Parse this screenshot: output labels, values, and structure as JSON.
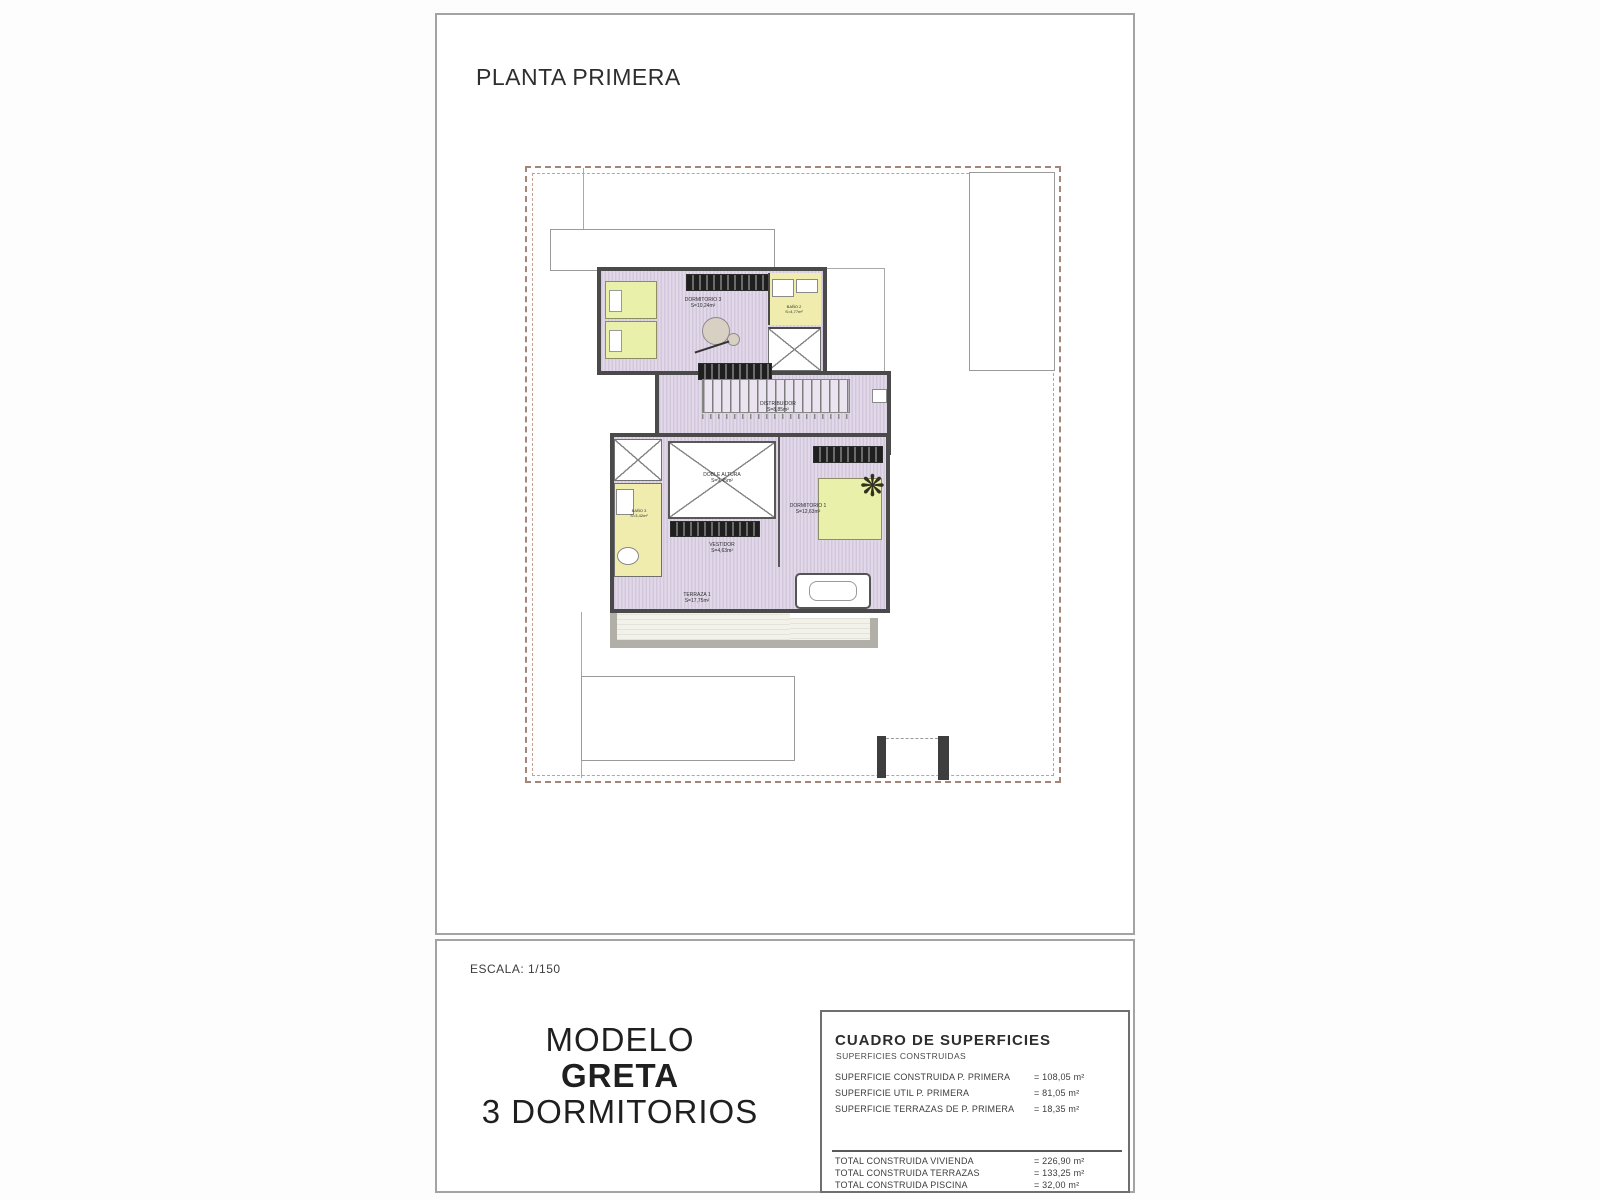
{
  "header": {
    "title": "PLANTA PRIMERA"
  },
  "footer": {
    "scale": "ESCALA: 1/150",
    "model": {
      "line1": "MODELO",
      "line2": "GRETA",
      "line3": "3 DORMITORIOS"
    },
    "surfaces": {
      "title": "CUADRO DE SUPERFICIES",
      "subtitle": "SUPERFICIES CONSTRUIDAS",
      "rows": [
        {
          "label": "SUPERFICIE CONSTRUIDA P. PRIMERA",
          "value": "= 108,05 m²"
        },
        {
          "label": "SUPERFICIE UTIL P. PRIMERA",
          "value": "= 81,05 m²"
        },
        {
          "label": "SUPERFICIE TERRAZAS DE P. PRIMERA",
          "value": "= 18,35 m²"
        }
      ],
      "totals": [
        {
          "label": "TOTAL CONSTRUIDA VIVIENDA",
          "value": "= 226,90 m²"
        },
        {
          "label": "TOTAL CONSTRUIDA TERRAZAS",
          "value": "= 133,25 m²"
        },
        {
          "label": "TOTAL CONSTRUIDA PISCINA",
          "value": "= 32,00 m²"
        }
      ]
    }
  },
  "plan": {
    "rooms": [
      {
        "name": "DORMITORIO 3",
        "area": "S=10,24m²"
      },
      {
        "name": "BAÑO 2",
        "area": "S=4,77m²"
      },
      {
        "name": "DISTRIBUIDOR",
        "area": "S=8,85m²"
      },
      {
        "name": "DOBLE ALTURA",
        "area": "S=9,45m²"
      },
      {
        "name": "BAÑO 3",
        "area": "S=3,42m²"
      },
      {
        "name": "VESTIDOR",
        "area": "S=4,63m²"
      },
      {
        "name": "DORMITORIO 1",
        "area": "S=12,63m²"
      },
      {
        "name": "TERRAZA 1",
        "area": "S=17,75m²"
      }
    ],
    "plant_icon": "❋",
    "colors": {
      "wall": "#4a4a4a",
      "floor_lavender": "#d8cce0",
      "bathroom_yellow": "#efecae",
      "bed_green": "#e9f0a9",
      "terrace_gray": "#eceadf",
      "parapet_gray": "#b2aea8",
      "boundary_dash": "#a3857a"
    }
  }
}
